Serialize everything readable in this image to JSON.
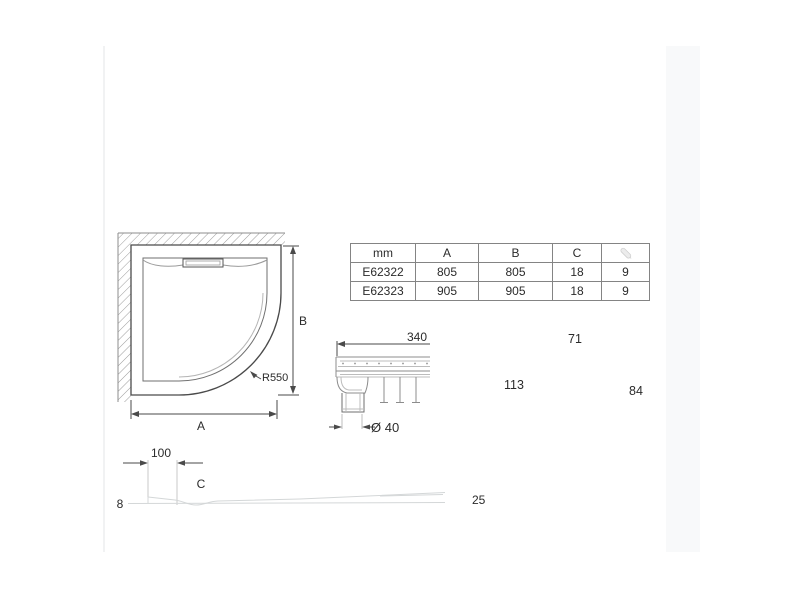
{
  "colors": {
    "line_dark": "#4a4a4a",
    "line_medium": "#8c8c8c",
    "line_light": "#bcbcbc",
    "line_faint": "#d4d7d8",
    "hatch": "#9c9c9c",
    "table_border": "#848484",
    "text": "#2b2b2b",
    "icon_gray": "#dcdcdc"
  },
  "spec_table": {
    "col_headers": [
      "mm",
      "A",
      "B",
      "C"
    ],
    "weight_icon_name": "weight-icon",
    "rows": [
      {
        "model": "E62322",
        "a": "805",
        "b": "805",
        "c": "18",
        "weight": "9"
      },
      {
        "model": "E62323",
        "a": "905",
        "b": "905",
        "c": "18",
        "weight": "9"
      }
    ]
  },
  "top_view": {
    "width_label": "A",
    "height_label": "B",
    "corner_radius_label": "R550"
  },
  "drain_section_view": {
    "width_label": "340",
    "drain_diameter_label": "Ø 40",
    "dim_71": "71",
    "dim_113": "113",
    "dim_84": "84"
  },
  "profile_view": {
    "offset_label": "100",
    "depth_label": "C",
    "left_height_label": "8",
    "right_height_label": "25"
  }
}
